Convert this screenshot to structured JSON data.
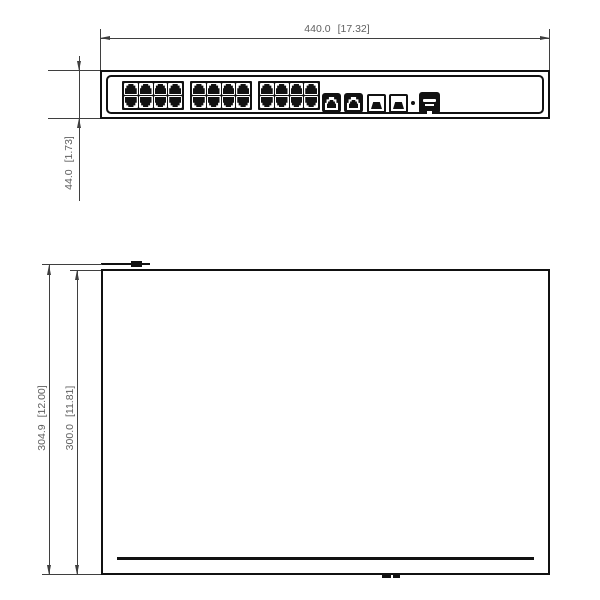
{
  "drawing": {
    "type": "technical-dimension-drawing",
    "subject": "24-port rack-mount network switch, front view and top view"
  },
  "colors": {
    "object_line": "#111111",
    "dim_line": "#3f3f3f",
    "dim_text": "#606060",
    "background": "#ffffff"
  },
  "front_view": {
    "dim_width": {
      "mm": "440.0",
      "inch": "[17.32]"
    },
    "dim_height": {
      "mm": "44.0",
      "inch": "[1.73]"
    },
    "panel": {
      "rj45_blocks": 3,
      "ports_per_block": 8,
      "rows_per_block": 2,
      "uplink_ports": 2,
      "sfp_ports": 2,
      "console_ports": 1,
      "reset_dot": 1
    }
  },
  "top_view": {
    "dim_outer": {
      "mm": "304.9",
      "inch": "[12.00]"
    },
    "dim_inner": {
      "mm": "300.0",
      "inch": "[11.81]"
    }
  }
}
